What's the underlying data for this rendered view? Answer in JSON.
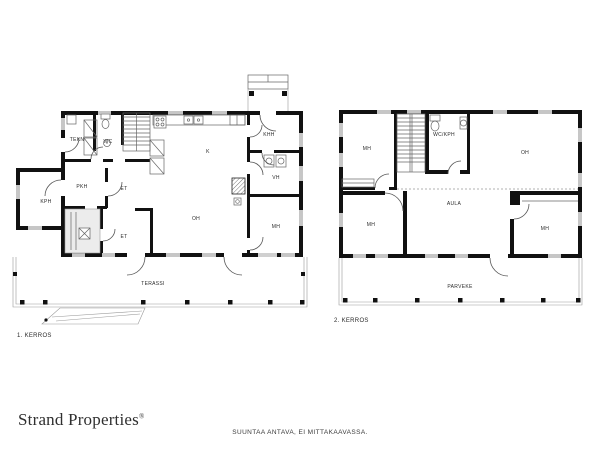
{
  "branding": {
    "logo_text": "Strand Properties",
    "registered_mark": "®"
  },
  "disclaimer": "SUUNTAA ANTAVA, EI MITTAKAAVASSA.",
  "floor1": {
    "caption": "1. KERROS",
    "rooms": {
      "tekn": "TEKN",
      "wc": "WC",
      "k": "K",
      "khh": "KHH",
      "pkh": "PKH",
      "et_upper": "ET",
      "kph": "KPH",
      "et_lower": "ET",
      "oh": "OH",
      "vh": "VH",
      "mh": "MH",
      "terassi": "TERASSI"
    }
  },
  "floor2": {
    "caption": "2. KERROS",
    "rooms": {
      "mh_top_left": "MH",
      "wc_kph": "WC/KPH",
      "oh": "OH",
      "aula": "AULA",
      "mh_bottom_left": "MH",
      "mh_bottom_right": "MH",
      "parveke": "PARVEKE"
    }
  },
  "colors": {
    "wall": "#111111",
    "background": "#ffffff",
    "label": "#2b2b2b"
  }
}
